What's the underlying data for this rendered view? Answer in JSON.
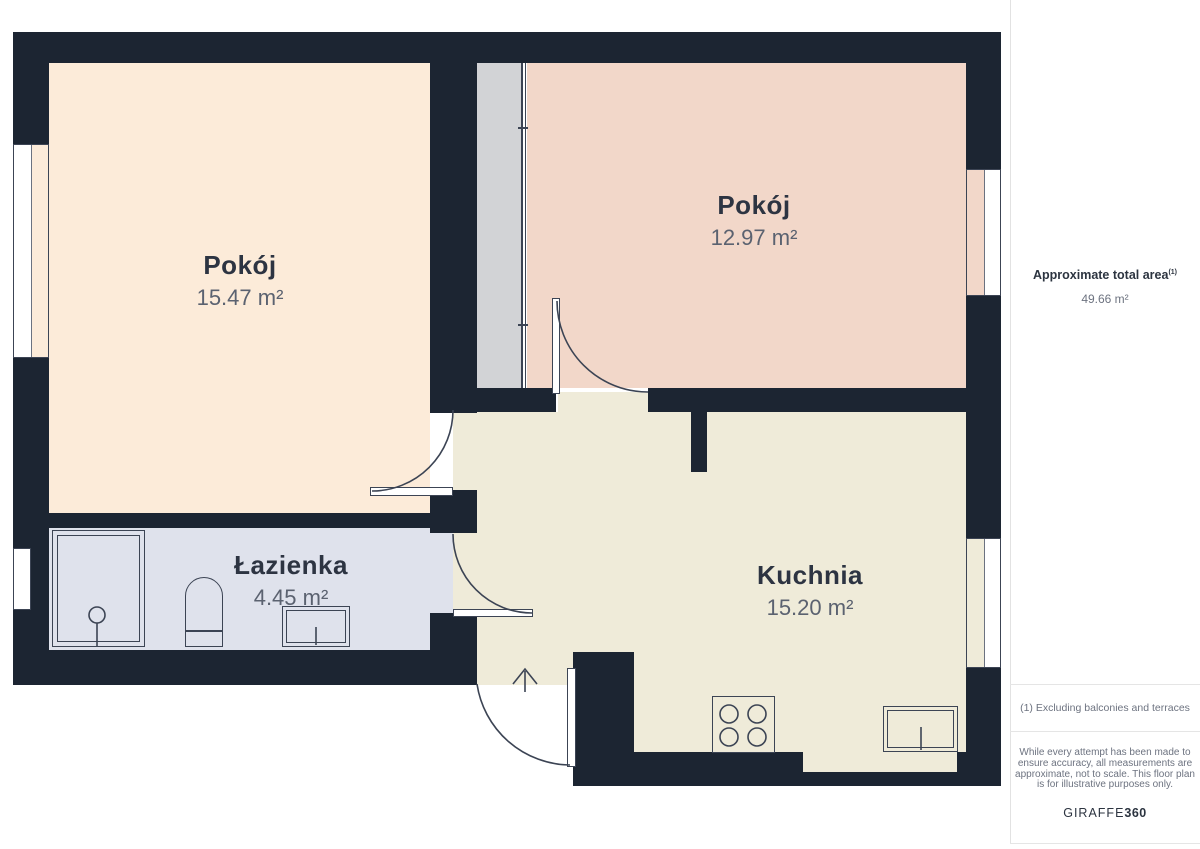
{
  "rooms": [
    {
      "name": "Pokój",
      "area": "15.47 m²"
    },
    {
      "name": "Pokój",
      "area": "12.97 m²"
    },
    {
      "name": "Łazienka",
      "area": "4.45 m²"
    },
    {
      "name": "Kuchnia",
      "area": "15.20 m²"
    }
  ],
  "sidebar": {
    "total_label": "Approximate total area",
    "total_footnote_marker": "(1)",
    "total_value": "49.66 m²",
    "footnote": "(1) Excluding balconies and terraces",
    "disclaimer": "While every attempt has been made to ensure accuracy, all measurements are approximate, not to scale. This floor plan is for illustrative purposes only.",
    "brand_name": "GIRAFFE",
    "brand_suffix": "360"
  },
  "colors": {
    "wall": "#1c2532",
    "room_pokoj_1": "#fcebd9",
    "room_pokoj_2": "#f2d7c9",
    "room_lazienka": "#dfe2ec",
    "room_kuchnia": "#efebd9",
    "wardrobe_strip": "#d2d3d6",
    "outline": "#3c4454",
    "label_dark": "#2d3442",
    "label_gray": "#5b6270",
    "sidebar_text": "#6d7380",
    "divider": "#e5e5e5"
  }
}
